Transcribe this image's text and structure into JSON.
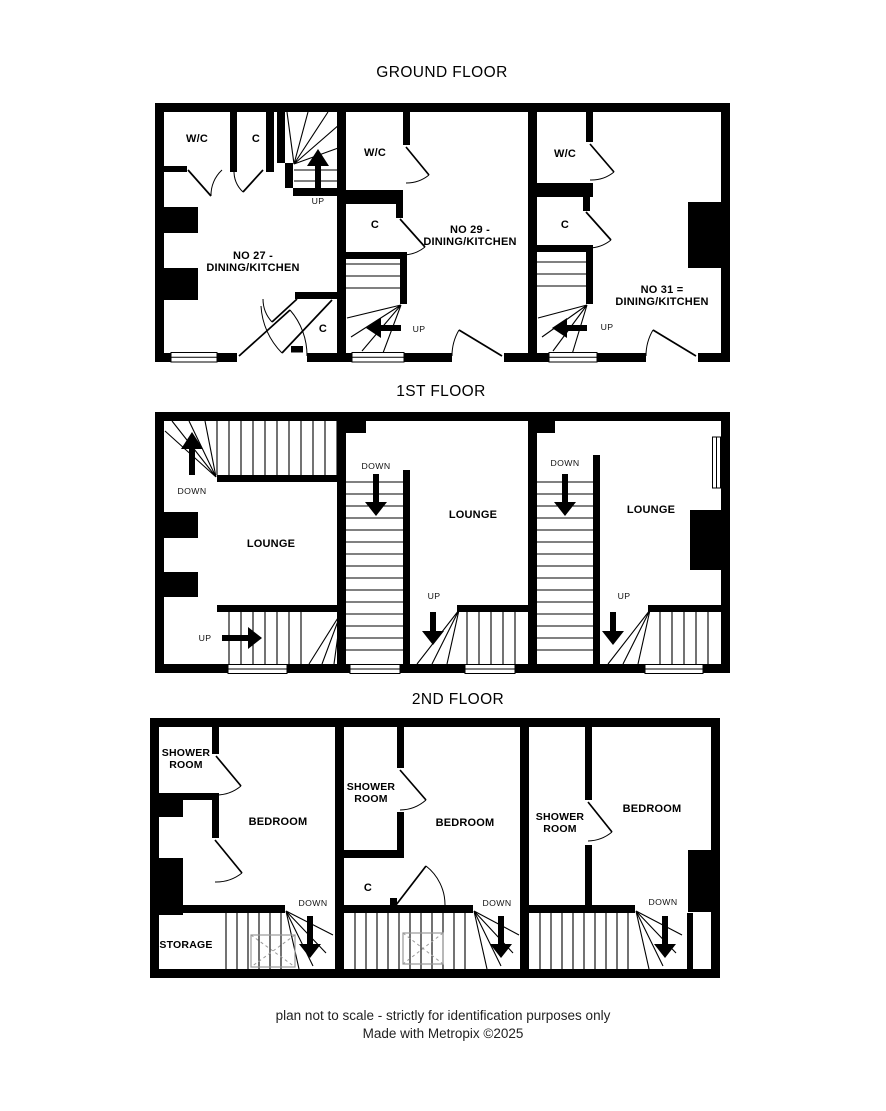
{
  "page": {
    "titles": {
      "ground": "GROUND FLOOR",
      "first": "1ST FLOOR",
      "second": "2ND FLOOR"
    },
    "footer": {
      "line1": "plan not to scale - strictly for identification purposes only",
      "line2": "Made with Metropix ©2025"
    }
  },
  "ground": {
    "unit27": {
      "wc": "W/C",
      "closet_top": "C",
      "closet_bottom": "C",
      "name_l1": "NO 27 -",
      "name_l2": "DINING/KITCHEN",
      "up": "UP"
    },
    "unit29": {
      "wc": "W/C",
      "closet": "C",
      "name_l1": "NO 29 -",
      "name_l2": "DINING/KITCHEN",
      "up": "UP"
    },
    "unit31": {
      "wc": "W/C",
      "closet": "C",
      "name_l1": "NO 31 =",
      "name_l2": "DINING/KITCHEN",
      "up": "UP"
    }
  },
  "first": {
    "unit27": {
      "lounge": "LOUNGE",
      "down": "DOWN",
      "up": "UP"
    },
    "unit29": {
      "lounge": "LOUNGE",
      "down": "DOWN",
      "up": "UP"
    },
    "unit31": {
      "lounge": "LOUNGE",
      "down": "DOWN",
      "up": "UP"
    }
  },
  "second": {
    "unit27": {
      "shower_l1": "SHOWER",
      "shower_l2": "ROOM",
      "bedroom": "BEDROOM",
      "storage": "STORAGE",
      "down": "DOWN"
    },
    "unit29": {
      "shower_l1": "SHOWER",
      "shower_l2": "ROOM",
      "bedroom": "BEDROOM",
      "closet": "C",
      "down": "DOWN"
    },
    "unit31": {
      "shower_l1": "SHOWER",
      "shower_l2": "ROOM",
      "bedroom": "BEDROOM",
      "down": "DOWN"
    }
  }
}
